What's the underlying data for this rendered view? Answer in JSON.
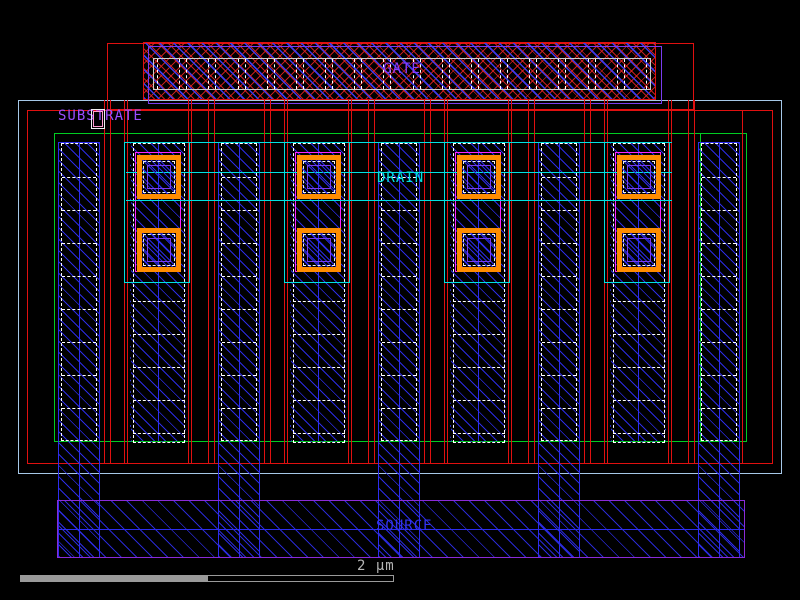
{
  "canvas": {
    "description": "IC layout viewer canvas, multi-finger MOSFET cell"
  },
  "labels": {
    "gate": "GATE",
    "substrate": "SUBSTRATE",
    "drain": "DRAIN",
    "source": "SOURCE"
  },
  "scalebar": {
    "label": "2 µm"
  },
  "structure": {
    "gate_contact_cells": 17,
    "source_fingers": 5,
    "drain_fingers": 4,
    "vias_per_drain_finger": 2,
    "cells_per_source_finger": 9,
    "drain_rail_lines": 3
  },
  "colors": {
    "background": "#000000",
    "boundary_blue": "#a6c8e8",
    "substrate_red": "#e01010",
    "well_green": "#00cc22",
    "metal_blue": "#2d2dee",
    "bus_outline_purple": "#8a2bd8",
    "gate_metal_purple": "#7a3cf0",
    "drain_metal_cyan": "#00e0e0",
    "contact_white": "#e8e8e8",
    "via_orange": "#ff8c00",
    "via_ring_magenta": "#ff22ff",
    "label_violet": "#9b4dff",
    "label_blue": "#3232f0",
    "scale_gray": "#9a9a9a",
    "marker_pink": "#ff9bd0"
  }
}
